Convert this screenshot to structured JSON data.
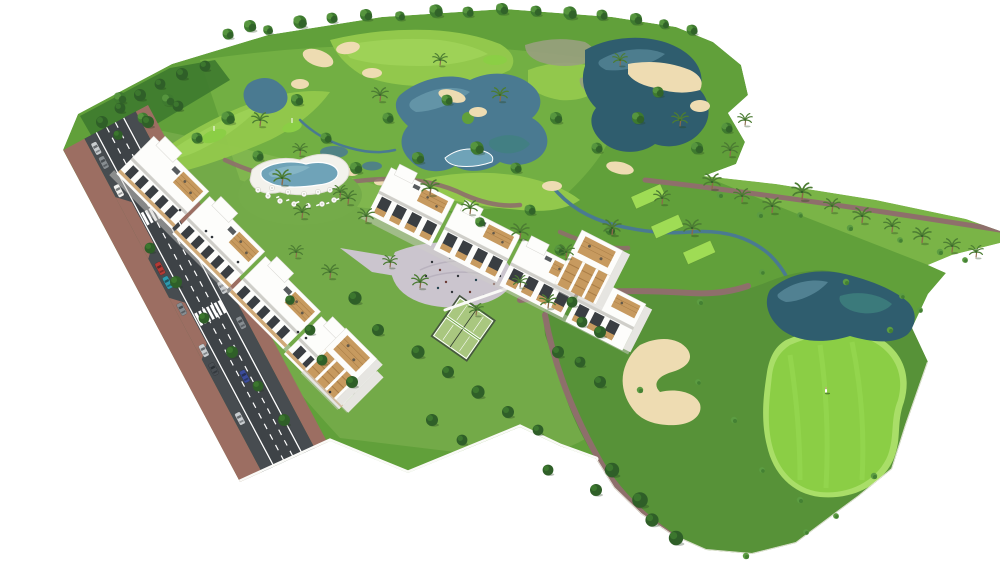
{
  "meta": {
    "scene_type": "aerial architectural rendering",
    "subject": "residential apartment complex beside a golf course",
    "background": "#FFFFFF"
  },
  "palette": {
    "courseBase": "#61A03A",
    "holeBase": "#579238",
    "fairway": "#92C84C",
    "fairwayLight": "#A8DB60",
    "teeGreen": "#9FDC55",
    "puttingGreen": "#8BCE45",
    "greenFringe": "#A9DE68",
    "water": "#4A7A91",
    "waterLight": "#74A5B6",
    "waterTeal": "#3F827E",
    "waterDark": "#2F5D6E",
    "sand": "#EEDCB2",
    "sandLight": "#F4E6C4",
    "scrub": "#99A07F",
    "path": "#8E6F6B",
    "road": "#3E4347",
    "road2": "#474C50",
    "roadLine": "#FFFFFF",
    "sidewalk": "#9C6E62",
    "building": "#FDFDFB",
    "buildingShade": "#E6E5E1",
    "buildingShadow": "#CFCEC9",
    "windowDark": "#3A3E42",
    "wood": "#C79A5F",
    "woodDark": "#A87C45",
    "tree": "#3E7A2F",
    "treeDark": "#2F5F28",
    "treeLight": "#5C9C42",
    "palm": "#4C7C33",
    "trunk": "#8A6B4A",
    "poolWater": "#6FA3B8",
    "poolLight": "#8FBCCB",
    "deck": "#F3F2EC",
    "lawn": "#74AB49",
    "plaza": "#CBC5CE",
    "plazaLine": "#B9B2BE",
    "court": "#A9C77F",
    "fence": "#46573F",
    "wall": "#FAFAF7",
    "wallShade": "#D9D7CF",
    "carRed": "#B53A35",
    "carBlue": "#3B4C9B",
    "carTeal": "#2E9AAE",
    "carSilver": "#C9CDD0",
    "carGray": "#878D91",
    "carDark": "#4A4F54",
    "carWhite": "#F2F2F0",
    "carGreen": "#4C7A46",
    "figure": "#2F3338"
  },
  "scene": {
    "regions": [
      "golf-course",
      "lakes",
      "sand-bunkers",
      "tee-boxes",
      "putting-greens",
      "apartment-building-a",
      "apartment-building-b",
      "roof-terraces",
      "swimming-pool",
      "sun-umbrellas",
      "central-plaza",
      "padel-courts",
      "gardens",
      "perimeter-wall",
      "access-road",
      "parked-cars",
      "zebra-crossings",
      "palm-hillside",
      "golf-green",
      "golfer",
      "golf-cart"
    ]
  }
}
